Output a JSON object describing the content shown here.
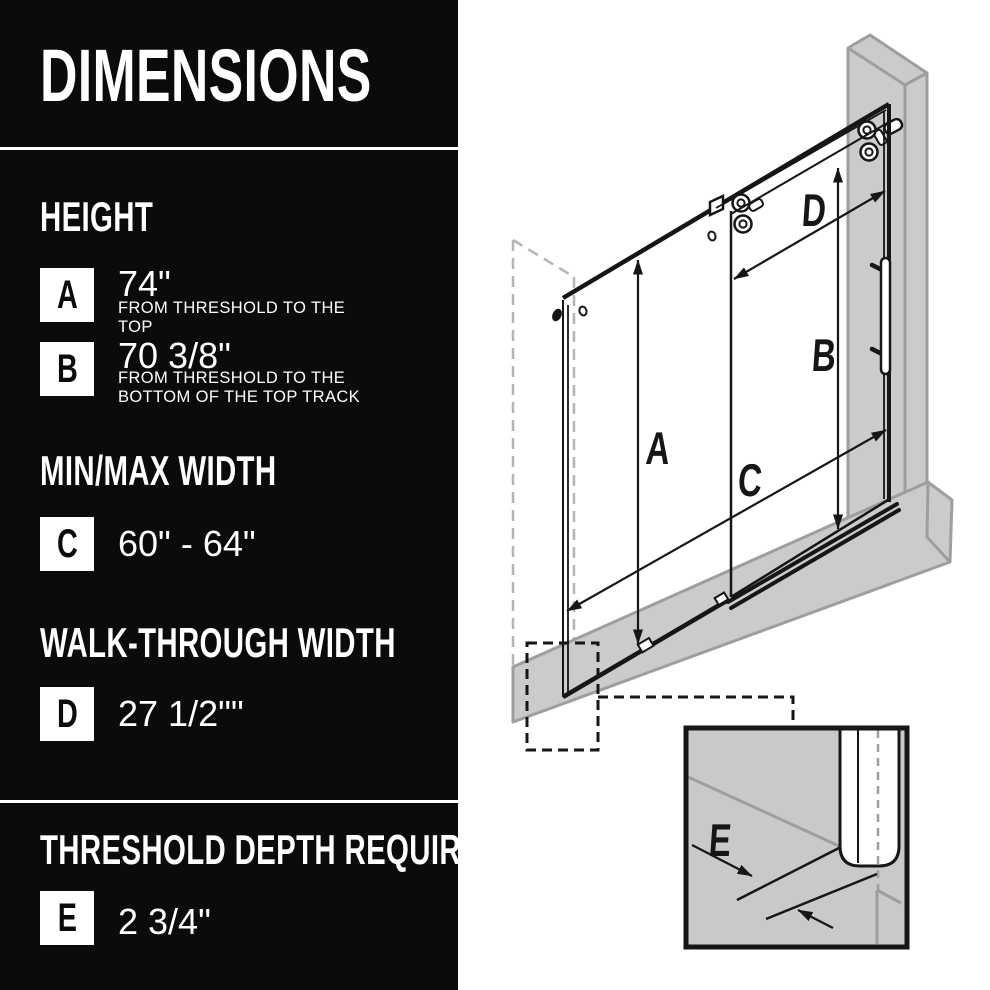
{
  "colors": {
    "panel_bg": "#0b0b0b",
    "panel_text": "#ffffff",
    "drawing_gray_fill": "#cbcbcb",
    "drawing_gray_line": "#9e9e9e",
    "drawing_ink": "#161616"
  },
  "panel": {
    "title": "DIMENSIONS",
    "sections": [
      {
        "heading": "HEIGHT",
        "rows": [
          {
            "letter": "A",
            "value": "74\"",
            "note": "FROM THRESHOLD TO THE TOP"
          },
          {
            "letter": "B",
            "value": "70 3/8\"",
            "note": "FROM THRESHOLD TO THE BOTTOM OF THE TOP TRACK"
          }
        ]
      },
      {
        "heading": "MIN/MAX WIDTH",
        "rows": [
          {
            "letter": "C",
            "value": "60\" - 64\"",
            "note": ""
          }
        ]
      },
      {
        "heading": "WALK-THROUGH WIDTH",
        "rows": [
          {
            "letter": "D",
            "value": "27 1/2\"\"",
            "note": ""
          }
        ]
      },
      {
        "heading": "THRESHOLD DEPTH REQUIRED",
        "rows": [
          {
            "letter": "E",
            "value": "2 3/4\"",
            "note": ""
          }
        ]
      }
    ]
  },
  "diagram": {
    "labels": {
      "a": "A",
      "b": "B",
      "c": "C",
      "d": "D",
      "e": "E"
    }
  }
}
